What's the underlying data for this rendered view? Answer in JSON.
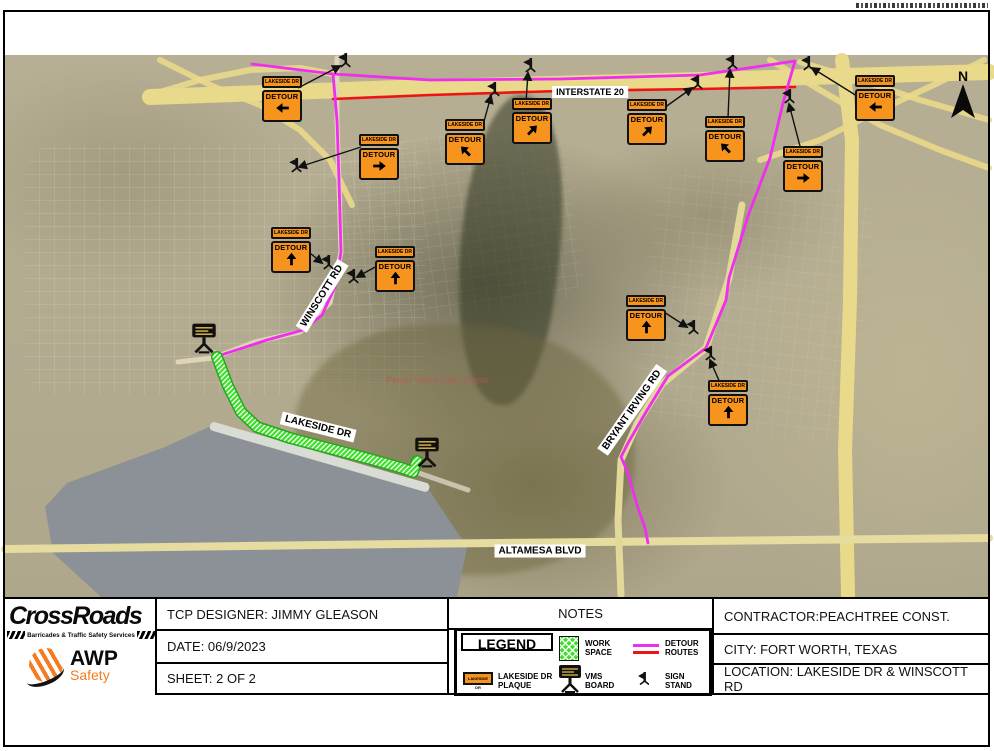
{
  "map": {
    "north_label": "N",
    "sign_plaque_text": "LAKESIDE DR",
    "sign_panel_text": "DETOUR",
    "golf_label": "Pecan Valley Golf Course",
    "road_labels": [
      {
        "text": "INTERSTATE 20",
        "x": 590,
        "y": 92,
        "rot": 0,
        "fs": 9
      },
      {
        "text": "WINSCOTT RD",
        "x": 322,
        "y": 296,
        "rot": -58,
        "fs": 10
      },
      {
        "text": "LAKESIDE DR",
        "x": 318,
        "y": 427,
        "rot": 14,
        "fs": 10
      },
      {
        "text": "BRYANT IRVING RD",
        "x": 632,
        "y": 410,
        "rot": -55,
        "fs": 10
      },
      {
        "text": "ALTAMESA BLVD",
        "x": 540,
        "y": 551,
        "rot": 0,
        "fs": 10
      }
    ],
    "signs": [
      {
        "x": 282,
        "y": 99,
        "dir": "left"
      },
      {
        "x": 379,
        "y": 157,
        "dir": "right"
      },
      {
        "x": 465,
        "y": 142,
        "dir": "nw"
      },
      {
        "x": 532,
        "y": 121,
        "dir": "ne"
      },
      {
        "x": 647,
        "y": 122,
        "dir": "ne"
      },
      {
        "x": 725,
        "y": 139,
        "dir": "nw"
      },
      {
        "x": 803,
        "y": 169,
        "dir": "right"
      },
      {
        "x": 875,
        "y": 98,
        "dir": "left"
      },
      {
        "x": 291,
        "y": 250,
        "dir": "up"
      },
      {
        "x": 395,
        "y": 269,
        "dir": "up"
      },
      {
        "x": 646,
        "y": 318,
        "dir": "up"
      },
      {
        "x": 728,
        "y": 403,
        "dir": "up"
      }
    ],
    "stands": [
      {
        "x": 344,
        "y": 63
      },
      {
        "x": 295,
        "y": 168
      },
      {
        "x": 493,
        "y": 92
      },
      {
        "x": 529,
        "y": 68
      },
      {
        "x": 696,
        "y": 85
      },
      {
        "x": 731,
        "y": 65
      },
      {
        "x": 788,
        "y": 99
      },
      {
        "x": 807,
        "y": 66
      },
      {
        "x": 327,
        "y": 265
      },
      {
        "x": 352,
        "y": 279
      },
      {
        "x": 692,
        "y": 330
      },
      {
        "x": 709,
        "y": 356
      }
    ],
    "leaders": [
      [
        298,
        88,
        340,
        66
      ],
      [
        361,
        147,
        299,
        167
      ],
      [
        483,
        125,
        491,
        96
      ],
      [
        526,
        102,
        528,
        73
      ],
      [
        664,
        108,
        692,
        88
      ],
      [
        728,
        118,
        730,
        70
      ],
      [
        801,
        150,
        789,
        104
      ],
      [
        857,
        96,
        812,
        68
      ],
      [
        310,
        253,
        322,
        263
      ],
      [
        377,
        266,
        357,
        277
      ],
      [
        664,
        312,
        687,
        327
      ],
      [
        721,
        385,
        710,
        360
      ]
    ],
    "vms_boards": [
      {
        "x": 204,
        "y": 341
      },
      {
        "x": 427,
        "y": 455
      }
    ],
    "routes": {
      "magenta_i20": [
        [
          252,
          64
        ],
        [
          333,
          74
        ],
        [
          430,
          80
        ],
        [
          560,
          79
        ],
        [
          700,
          75
        ],
        [
          762,
          66
        ],
        [
          795,
          61
        ],
        [
          783,
          103
        ],
        [
          770,
          158
        ],
        [
          748,
          216
        ],
        [
          729,
          278
        ],
        [
          726,
          300
        ],
        [
          706,
          348
        ],
        [
          668,
          376
        ],
        [
          646,
          412
        ],
        [
          628,
          443
        ],
        [
          621,
          457
        ],
        [
          628,
          473
        ],
        [
          637,
          505
        ],
        [
          645,
          528
        ],
        [
          648,
          543
        ]
      ],
      "magenta_winscott": [
        [
          333,
          74
        ],
        [
          337,
          120
        ],
        [
          339,
          180
        ],
        [
          341,
          252
        ],
        [
          335,
          287
        ],
        [
          322,
          315
        ],
        [
          303,
          330
        ],
        [
          267,
          340
        ],
        [
          215,
          357
        ]
      ],
      "red": [
        [
          333,
          99
        ],
        [
          430,
          95
        ],
        [
          560,
          91
        ],
        [
          700,
          89
        ],
        [
          795,
          87
        ]
      ],
      "workspace": [
        [
          217,
          357
        ],
        [
          228,
          386
        ],
        [
          241,
          412
        ],
        [
          257,
          427
        ],
        [
          290,
          438
        ],
        [
          328,
          448
        ],
        [
          370,
          459
        ],
        [
          402,
          468
        ],
        [
          413,
          472
        ],
        [
          417,
          461
        ]
      ],
      "i20_road": [
        [
          150,
          97
        ],
        [
          400,
          88
        ],
        [
          700,
          80
        ],
        [
          989,
          72
        ]
      ],
      "bryant_road": [
        [
          742,
          205
        ],
        [
          729,
          278
        ],
        [
          706,
          348
        ],
        [
          662,
          384
        ],
        [
          637,
          424
        ],
        [
          621,
          460
        ],
        [
          618,
          520
        ],
        [
          621,
          595
        ]
      ],
      "winscott_road": [
        [
          337,
          58
        ],
        [
          337,
          120
        ],
        [
          341,
          252
        ],
        [
          330,
          303
        ],
        [
          300,
          332
        ],
        [
          255,
          342
        ],
        [
          213,
          358
        ],
        [
          178,
          362
        ]
      ],
      "lakeside_road": [
        [
          215,
          352
        ],
        [
          230,
          390
        ],
        [
          248,
          420
        ],
        [
          270,
          432
        ],
        [
          340,
          450
        ],
        [
          410,
          470
        ],
        [
          468,
          490
        ]
      ],
      "altamesa_road": [
        [
          5,
          549
        ],
        [
          400,
          544
        ],
        [
          700,
          541
        ],
        [
          989,
          538
        ]
      ],
      "hwy_right": [
        [
          842,
          60
        ],
        [
          852,
          140
        ],
        [
          850,
          300
        ],
        [
          845,
          450
        ],
        [
          848,
          595
        ]
      ],
      "ramp1": [
        [
          770,
          60
        ],
        [
          820,
          90
        ],
        [
          880,
          125
        ],
        [
          940,
          150
        ],
        [
          989,
          168
        ]
      ],
      "ramp2": [
        [
          989,
          120
        ],
        [
          920,
          100
        ],
        [
          860,
          80
        ],
        [
          800,
          62
        ]
      ],
      "ramp3": [
        [
          760,
          160
        ],
        [
          820,
          140
        ],
        [
          880,
          110
        ],
        [
          940,
          82
        ],
        [
          984,
          60
        ]
      ],
      "ramp4": [
        [
          150,
          95
        ],
        [
          200,
          80
        ],
        [
          250,
          70
        ],
        [
          300,
          68
        ],
        [
          333,
          74
        ]
      ],
      "ramp5": [
        [
          160,
          60
        ],
        [
          210,
          85
        ],
        [
          260,
          105
        ],
        [
          300,
          130
        ],
        [
          330,
          160
        ],
        [
          352,
          205
        ]
      ]
    },
    "colors": {
      "detour_pink": "#ee2fee",
      "detour_red": "#ee1414",
      "workspace_green": "#3fe02c",
      "workspace_edge": "#23a81a",
      "sign_orange": "#f7941e",
      "road_yellow": "#e9d98b",
      "road_pale": "#ddd5b5"
    }
  },
  "titleblock": {
    "designer": "TCP DESIGNER: JIMMY GLEASON",
    "date": "DATE: 06/9/2023",
    "sheet": "SHEET: 2 OF 2",
    "notes": "NOTES",
    "contractor": "CONTRACTOR:PEACHTREE CONST.",
    "city": "CITY: FORT WORTH, TEXAS",
    "location": "LOCATION: LAKESIDE DR & WINSCOTT RD",
    "legend": {
      "title": "LEGEND",
      "work_space": "WORK SPACE",
      "detour_routes": "DETOUR ROUTES",
      "plaque_label": "LAKESIDE DR PLAQUE",
      "plaque_text": "LAKESIDE DR",
      "vms_board": "VMS BOARD",
      "sign_stand": "SIGN STAND"
    }
  },
  "branding": {
    "crossroads_name": "CrossRoads",
    "crossroads_sub": "Barricades & Traffic Safety Services",
    "awp_name": "AWP",
    "awp_sub": "Safety"
  }
}
